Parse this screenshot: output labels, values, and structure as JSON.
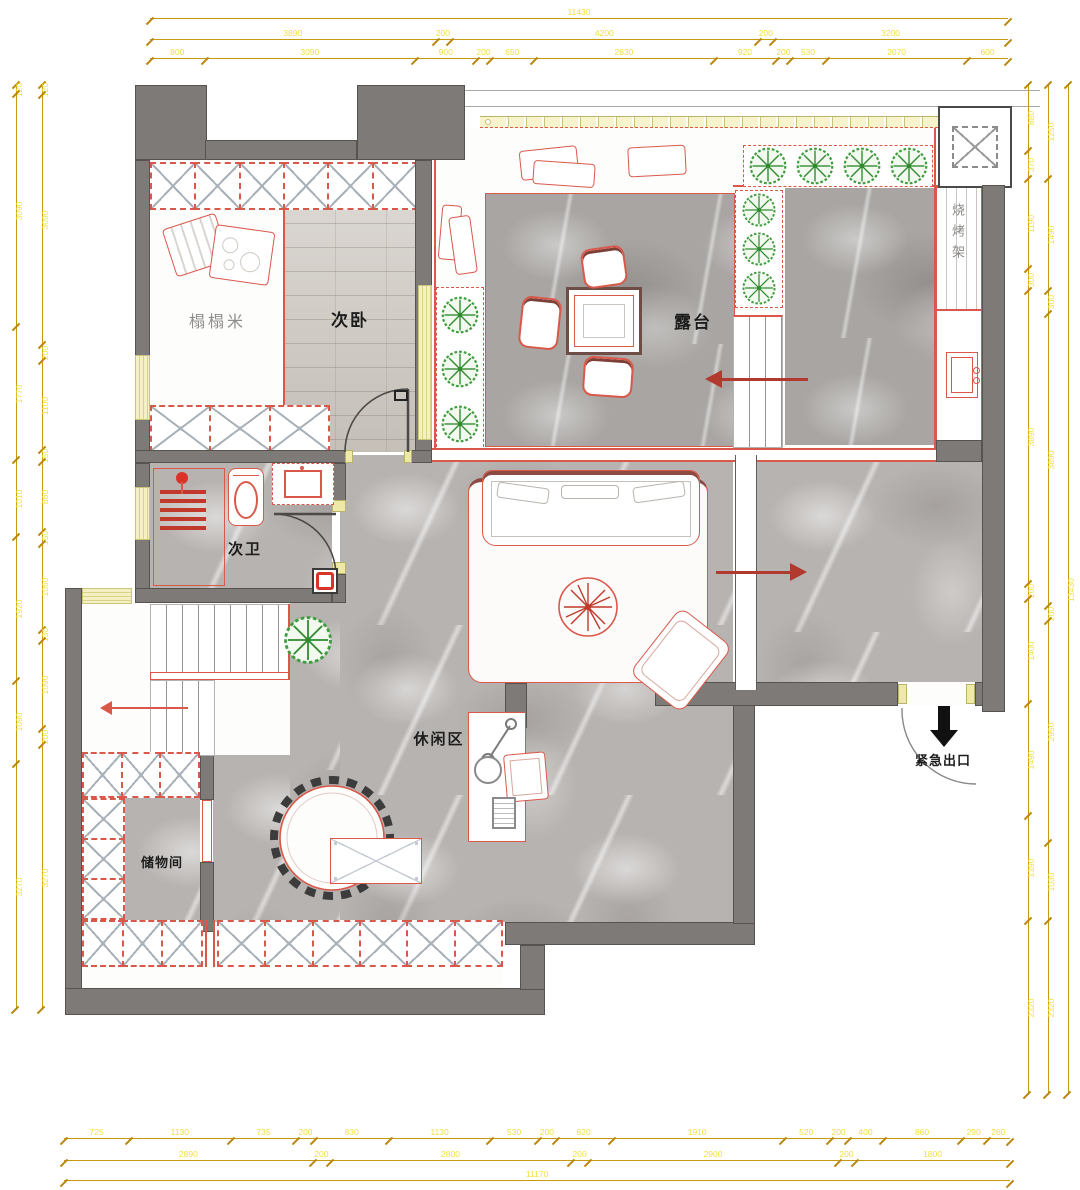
{
  "labels": {
    "tatami": "榻榻米",
    "bedroom": "次卧",
    "terrace": "露台",
    "bathroom": "次卫",
    "leisure": "休闲区",
    "storage": "储物间",
    "bbq": "烧烤架",
    "emergency_exit": "紧急出口"
  },
  "colors": {
    "accent_red": "#d9584a",
    "arrow_red": "#b03a2e",
    "dim_line_gold": "#c59a12",
    "dim_text_yellow": "#f2df3d",
    "wall_gray": "#7d7a77",
    "plant_green": "#3f9c3f",
    "window_yellow": "#f4f0c2"
  },
  "dims": {
    "top": {
      "row1": [
        11430
      ],
      "row2": [
        3890,
        200,
        4200,
        200,
        3200
      ],
      "row3": [
        800,
        3090,
        900,
        200,
        650,
        2630,
        920,
        200,
        530,
        2070,
        600
      ]
    },
    "bottom": {
      "row1": [
        725,
        1130,
        735,
        200,
        830,
        1130,
        530,
        200,
        620,
        1910,
        520,
        200,
        400,
        860,
        290,
        260
      ],
      "row2": [
        2890,
        200,
        2800,
        200,
        2900,
        200,
        1800
      ],
      "row3": [
        11170
      ]
    },
    "left": {
      "outer": [
        120,
        3090,
        1770,
        1010,
        1920,
        1090,
        3270
      ],
      "inner": [
        120,
        3090,
        200,
        1100,
        150,
        860,
        150,
        1060,
        130,
        1090,
        200,
        3270
      ]
    },
    "right": {
      "inner": [
        880,
        370,
        1190,
        300,
        3890,
        200,
        1400,
        1490,
        1390,
        2320
      ],
      "mid": [
        1250,
        1490,
        300,
        3890,
        200,
        2950,
        1030,
        2320
      ],
      "outer": [
        13430
      ]
    }
  }
}
